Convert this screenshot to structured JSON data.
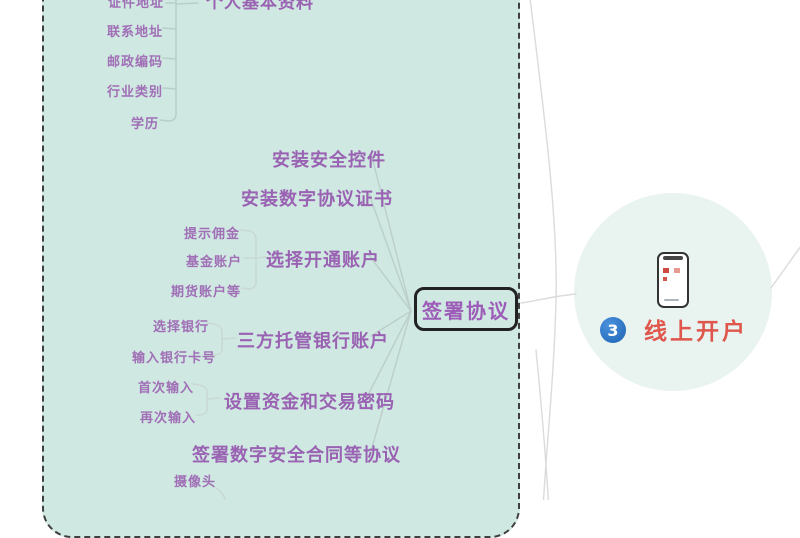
{
  "colors": {
    "panel_fill": "#cfe8e2",
    "panel_border": "#3f3f3f",
    "item_purple": "#a06fb6",
    "bold_purple": "#9a62b2",
    "node_text_purple": "#9c5cb8",
    "node_border": "#222222",
    "step_red": "#df564d",
    "badge_blue": "#2d78cc",
    "circle_fill": "#e9f3f0",
    "connector_gray": "#bccfcb"
  },
  "mindmap": {
    "center_node": "签署协议",
    "personal_info_group": {
      "parent_partial": "个人基本资料",
      "first_item_partial": "证件地址",
      "items": [
        "联系地址",
        "邮政编码",
        "行业类别",
        "学历"
      ]
    },
    "install_control": "安装安全控件",
    "install_cert": "安装数字协议证书",
    "choose_account": {
      "label": "选择开通账户",
      "children": [
        "提示佣金",
        "基金账户",
        "期货账户等"
      ]
    },
    "custody_bank": {
      "label": "三方托管银行账户",
      "children": [
        "选择银行",
        "输入银行卡号"
      ]
    },
    "set_password": {
      "label": "设置资金和交易密码",
      "children": [
        "首次输入",
        "再次输入"
      ]
    },
    "sign_contract": {
      "label": "签署数字安全合同等协议",
      "children": [
        "摄像头"
      ]
    }
  },
  "step": {
    "number": "3",
    "label": "线上开户"
  }
}
